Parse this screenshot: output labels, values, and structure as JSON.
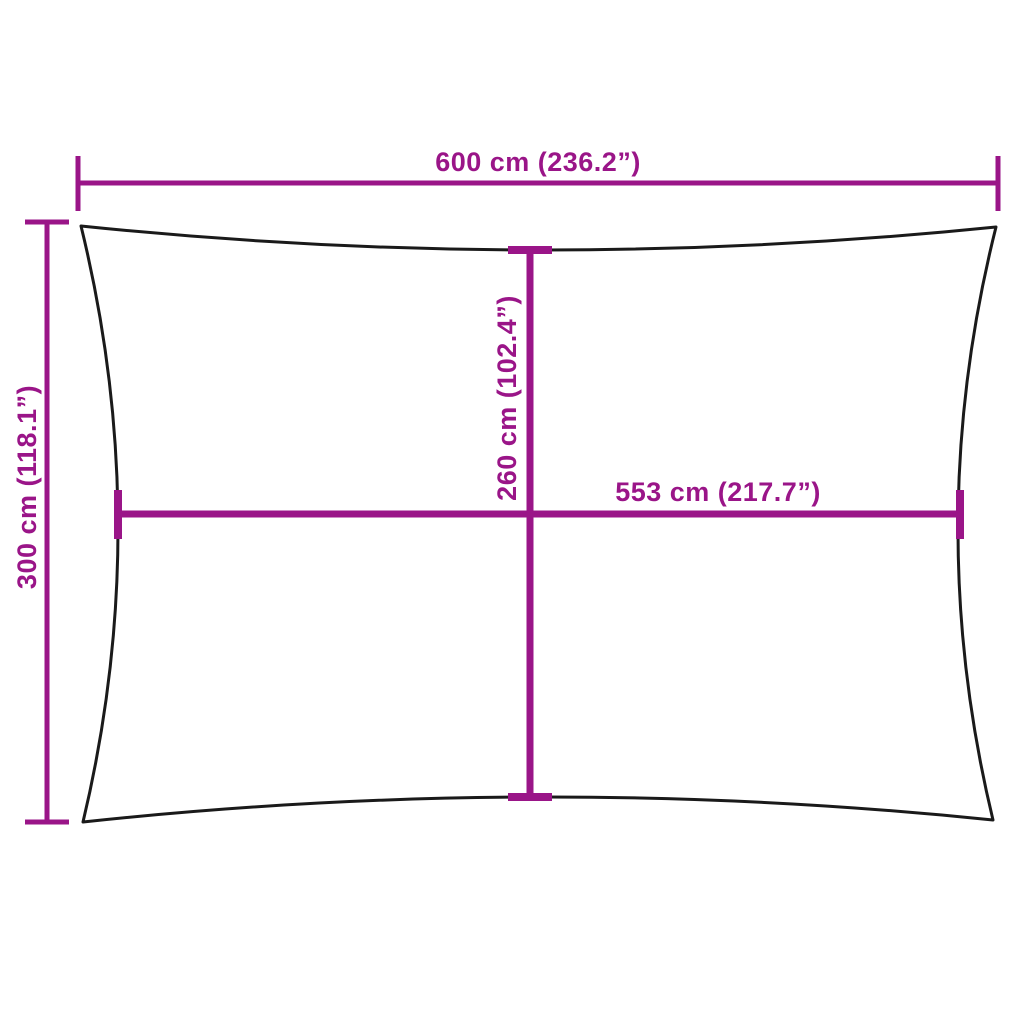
{
  "figure": {
    "type": "product-dimension-diagram",
    "background_color": "#ffffff",
    "outline_color": "#1a1a1a",
    "dimension_color": "#9a1588",
    "labels": {
      "overall_width": "600 cm (236.2”)",
      "overall_height": "300 cm (118.1”)",
      "inner_height": "260 cm (102.4”)",
      "inner_width": "553 cm (217.7”)"
    },
    "values": {
      "overall_width_cm": 600,
      "overall_width_in": 236.2,
      "overall_height_cm": 300,
      "overall_height_in": 118.1,
      "inner_height_cm": 260,
      "inner_height_in": 102.4,
      "inner_width_cm": 553,
      "inner_width_in": 217.7
    }
  }
}
